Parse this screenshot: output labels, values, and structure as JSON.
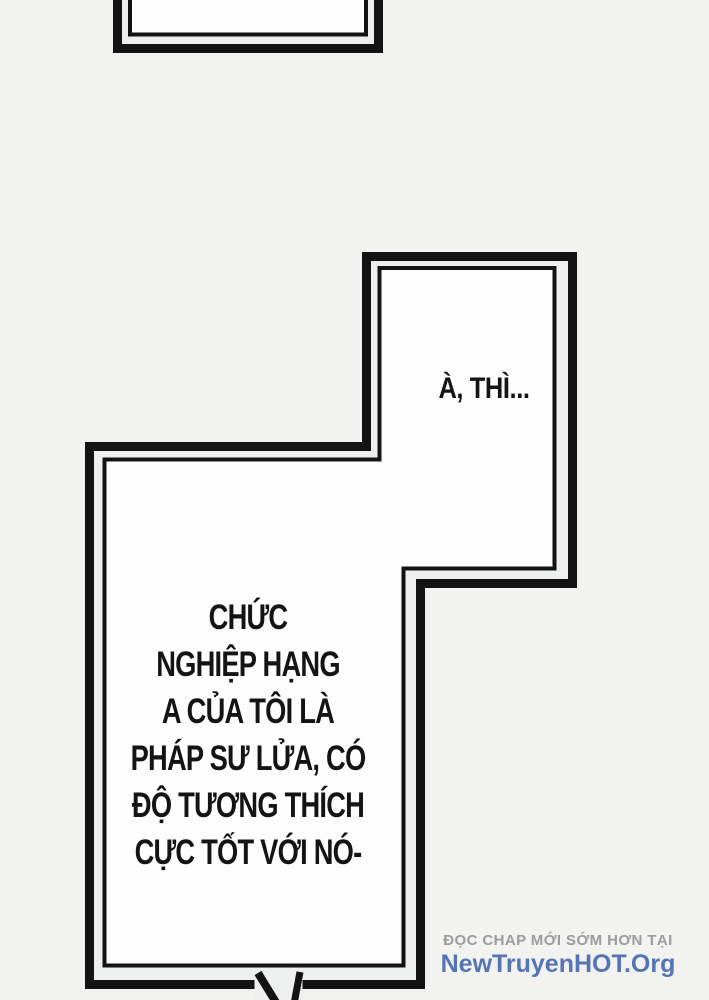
{
  "theme": {
    "page_bg": "#f2f3f1",
    "bubble_fill": "#fdfdfd",
    "bubble_gap": "#edf0ee",
    "line_color": "#131313",
    "text_color": "#141414",
    "watermark_gray": "#9c9c9c",
    "watermark_blue": "#5574b4"
  },
  "speech": {
    "reply": "À, THÌ...",
    "lines": [
      "CHỨC",
      "NGHIỆP HẠNG",
      "A CỦA TÔI LÀ",
      "PHÁP SƯ LỬA, CÓ",
      "ĐỘ TƯƠNG THÍCH",
      "CỰC TỐT VỚI NÓ-"
    ]
  },
  "watermark": {
    "line1": "ĐỌC CHAP MỚI SỚM HƠN TẠI",
    "line2": "NewTruyenHOT.Org"
  }
}
